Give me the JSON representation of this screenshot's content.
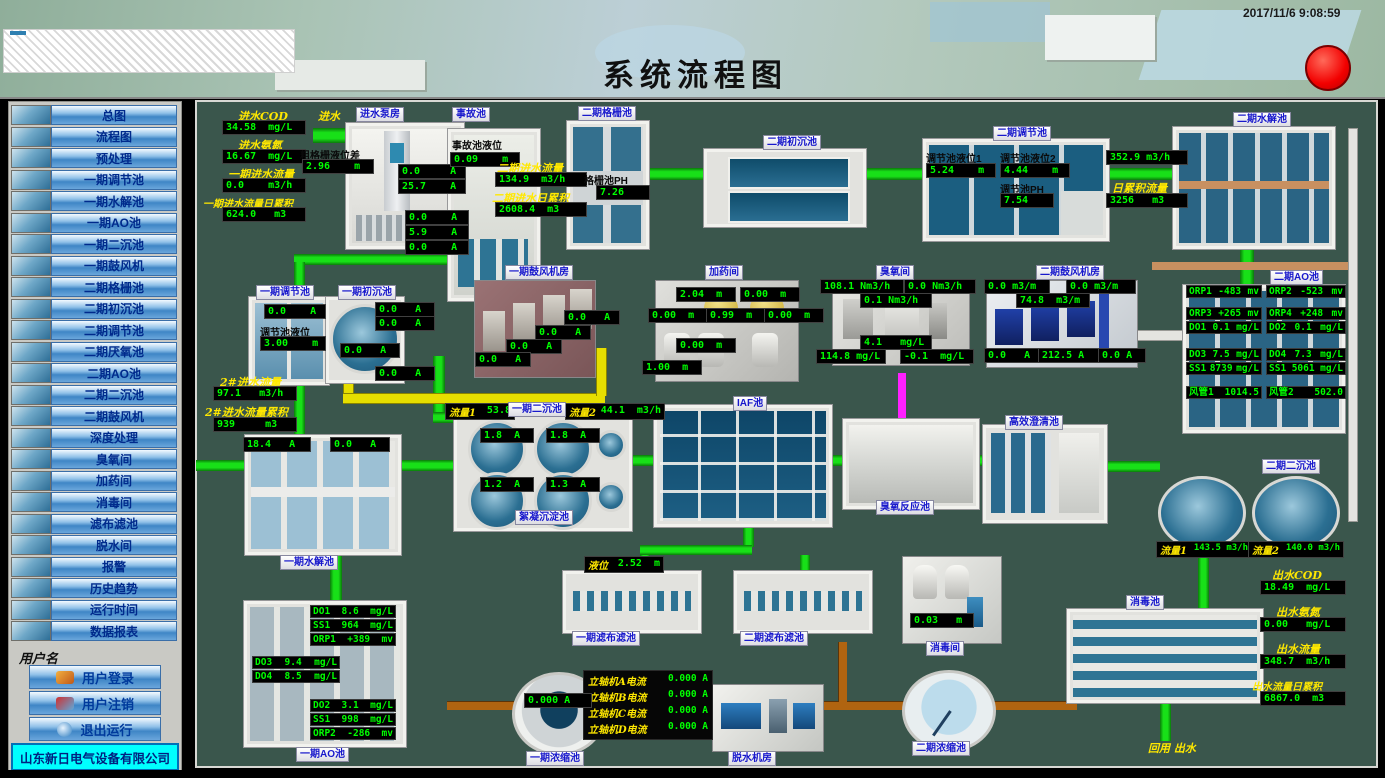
{
  "header": {
    "title": "系统流程图",
    "timestamp": "2017/11/6 9:08:59"
  },
  "sidebar": {
    "items": [
      "总图",
      "流程图",
      "预处理",
      "一期调节池",
      "一期水解池",
      "一期AO池",
      "一期二沉池",
      "一期鼓风机",
      "二期格栅池",
      "二期初沉池",
      "二期调节池",
      "二期厌氧池",
      "二期AO池",
      "二期二沉池",
      "二期鼓风机",
      "深度处理",
      "臭氧间",
      "加药间",
      "消毒间",
      "滤布滤池",
      "脱水间",
      "报警",
      "历史趋势",
      "运行时间",
      "数据报表"
    ],
    "username_label": "用户名",
    "login": "用户登录",
    "logout": "用户注销",
    "exit": "退出运行",
    "company": "山东新日电气设备有限公司"
  },
  "influent": {
    "cod_label": "进水COD",
    "cod": "34.58  mg/L",
    "nh3_label": "进水氨氮",
    "nh3": "16.67  mg/L",
    "flow_label": "一期进水流量",
    "flow": "0.0    m3/h",
    "acc_label": "一期进水流量日累积",
    "acc": "624.0   m3"
  },
  "pump": {
    "inlet_label": "进水",
    "tag": "进水泵房",
    "screen_label": "粗格栅液位差",
    "screen_level": "2.96    m",
    "c1": "0.0     A",
    "c2": "25.7    A",
    "c3": "0.0    A",
    "c4": "5.9    A",
    "c5": "0.0    A"
  },
  "accident": {
    "tag": "事故池",
    "level_label": "事故池液位",
    "level": "0.09    m"
  },
  "p2in": {
    "flow_label": "二期进水流量",
    "flow": "134.9  m3/h",
    "acc_label": "二期进水日累积",
    "acc": "2608.4  m3"
  },
  "grid": {
    "tag": "二期格栅池",
    "ph_label": "格栅池PH",
    "ph": "7.26"
  },
  "p2primary": {
    "tag": "二期初沉池"
  },
  "p2reg": {
    "tag": "二期调节池",
    "lv1_label": "调节池液位1",
    "lv1": "5.24    m",
    "lv2_label": "调节池液位2",
    "lv2": "4.44    m",
    "ph_label": "调节池PH",
    "ph": "7.54"
  },
  "p2hydro": {
    "tag": "二期水解池",
    "flow": "352.9 m3/h",
    "acc_label": "日累积流量",
    "acc": "3256   m3"
  },
  "p1reg": {
    "tag": "一期调节池",
    "current": "0.0    A",
    "lv_label": "调节池液位",
    "lv": "3.00    m"
  },
  "p1primary": {
    "tag": "一期初沉池",
    "c1": "0.0   A",
    "c2": "0.0   A",
    "c3": "0.0   A",
    "c4": "0.0   A"
  },
  "flow2": {
    "flow_label": "2#进水流量",
    "flow": "97.1   m3/h",
    "acc_label": "2#进水流量累积",
    "acc": "939     m3"
  },
  "p1blower": {
    "tag": "一期鼓风机房",
    "c1": "0.0   A",
    "c2": "0.0   A",
    "c3": "0.0   A",
    "c4": "0.0   A"
  },
  "dosing": {
    "tag": "加药间",
    "v1": "2.04  m",
    "v2": "0.00  m",
    "v3": "0.00  m",
    "v4": "0.99  m",
    "v5": "0.00  m",
    "v6": "0.00  m",
    "v7": "1.00  m"
  },
  "ozone": {
    "tag": "臭氧间",
    "v1": "108.1 Nm3/h",
    "v2": "0.0 Nm3/h",
    "v3": "0.1 Nm3/h",
    "v4": "4.1   mg/L",
    "v5": "114.8 mg/L",
    "v6": "-0.1  mg/L"
  },
  "p2blower": {
    "tag": "二期鼓风机房",
    "v1": "0.0 m3/m",
    "v2": "0.0 m3/m",
    "v3": "74.8  m3/m",
    "a1": "0.0   A",
    "a2": "212.5 A",
    "a3": "0.0 A"
  },
  "p2ao": {
    "tag": "二期AO池",
    "left": [
      {
        "l": "ORP1",
        "v": "-483",
        "u": "mv"
      },
      {
        "l": "ORP3",
        "v": "+265",
        "u": "mv"
      },
      {
        "l": "DO1",
        "v": "0.1",
        "u": "mg/L"
      },
      {
        "l": "DO3",
        "v": "7.5",
        "u": "mg/L"
      },
      {
        "l": "SS1",
        "v": "8739",
        "u": "mg/L"
      },
      {
        "l": "风管1",
        "v": "1014.5",
        "u": ""
      }
    ],
    "right": [
      {
        "l": "ORP2",
        "v": "-523",
        "u": "mv"
      },
      {
        "l": "ORP4",
        "v": "+248",
        "u": "mv"
      },
      {
        "l": "DO2",
        "v": "0.1",
        "u": "mg/L"
      },
      {
        "l": "DO4",
        "v": "7.3",
        "u": "mg/L"
      },
      {
        "l": "SS1",
        "v": "5061",
        "u": "mg/L"
      },
      {
        "l": "风管2",
        "v": "502.0",
        "u": ""
      }
    ]
  },
  "p1hydro": {
    "tag": "一期水解池",
    "c1": "18.4   A",
    "c2": "0.0   A"
  },
  "p1secondary": {
    "tag": "一期二沉池",
    "tag2": "絮凝沉淀池",
    "f1_label": "流量1",
    "f1": "53.8",
    "f2_label": "流量2",
    "f2": "44.1  m3/h",
    "c1": "1.8  A",
    "c2": "1.8  A",
    "c3": "1.2  A",
    "c4": "1.3  A"
  },
  "iaf": {
    "tag": "IAF池"
  },
  "ozone_reactor": {
    "tag": "臭氧反应池"
  },
  "clarifier": {
    "tag": "高效澄清池"
  },
  "p2secondary": {
    "tag": "二期二沉池",
    "f1_label": "流量1",
    "f1": "143.5 m3/h",
    "f2_label": "流量2",
    "f2": "140.0 m3/h"
  },
  "filter1": {
    "tag": "一期滤布滤池",
    "lv_label": "液位",
    "lv": "2.52  m"
  },
  "filter2": {
    "tag": "二期滤布滤池"
  },
  "disinfect_room": {
    "tag": "消毒间",
    "lv": "0.03   m"
  },
  "disinfect_pool": {
    "tag": "消毒池"
  },
  "p1ao": {
    "tag": "一期AO池",
    "top": [
      {
        "l": "DO1",
        "v": "8.6",
        "u": "mg/L"
      },
      {
        "l": "SS1",
        "v": "964",
        "u": "mg/L"
      },
      {
        "l": "ORP1",
        "v": "+389",
        "u": "mv"
      }
    ],
    "mid": [
      {
        "l": "DO3",
        "v": "9.4",
        "u": "mg/L"
      },
      {
        "l": "DO4",
        "v": "8.5",
        "u": "mg/L"
      }
    ],
    "bottom": [
      {
        "l": "DO2",
        "v": "3.1",
        "u": "mg/L"
      },
      {
        "l": "SS1",
        "v": "998",
        "u": "mg/L"
      },
      {
        "l": "ORP2",
        "v": "-286",
        "u": "mv"
      }
    ]
  },
  "dewater_panel": {
    "rows": [
      {
        "l": "立轴机A电流",
        "v": "0.000 A"
      },
      {
        "l": "立轴机B电流",
        "v": "0.000 A"
      },
      {
        "l": "立轴机C电流",
        "v": "0.000 A"
      },
      {
        "l": "立轴机D电流",
        "v": "0.000 A"
      }
    ]
  },
  "thickener1": {
    "tag": "一期浓缩池",
    "current": "0.000 A"
  },
  "dewater_room": {
    "tag": "脱水机房"
  },
  "thickener2": {
    "tag": "二期浓缩池"
  },
  "effluent": {
    "cod_label": "出水COD",
    "cod": "18.49  mg/L",
    "nh3_label": "出水氨氮",
    "nh3": "0.00   mg/L",
    "flow_label": "出水流量",
    "flow": "348.7  m3/h",
    "acc_label": "出水流量日累积",
    "acc": "6867.0  m3"
  },
  "reuse_label": "回用  出水",
  "colors": {
    "pipe_green": "#18e018",
    "pipe_yellow": "#e6de00",
    "pipe_magenta": "#ff20ff",
    "pipe_orange": "#b06410",
    "display_green": "#00ff00",
    "label_yellow": "#ffe800",
    "background": "#3a564c",
    "company_bg": "#00ffff",
    "alarm_red": "#f20000"
  }
}
